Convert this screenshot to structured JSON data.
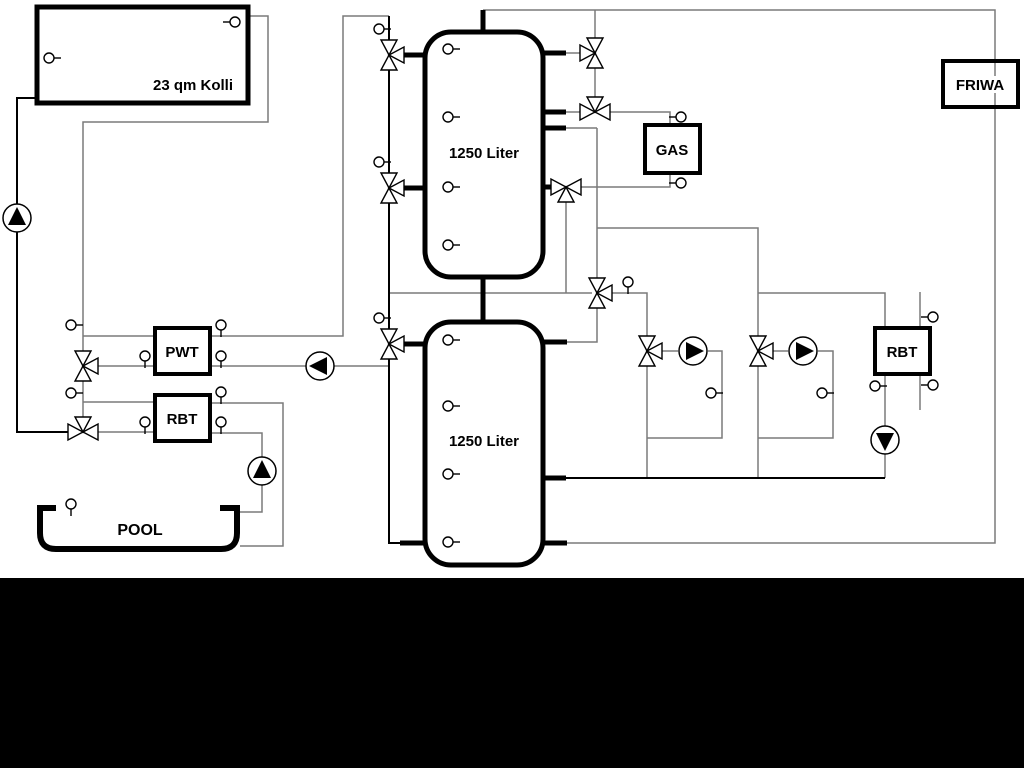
{
  "diagram_title": "hydraulic-heating-schematic",
  "labels": {
    "collector": "23 qm Kolli",
    "tank_top": "1250 Liter",
    "tank_bottom": "1250 Liter",
    "gas": "GAS",
    "friwa": "FRIWA",
    "pwt": "PWT",
    "rbt_left": "RBT",
    "rbt_right": "RBT",
    "pool": "POOL"
  },
  "colors": {
    "line_gray": "#7a7a7a",
    "line_black": "#000000",
    "background": "#ffffff",
    "bottom_band": "#000000",
    "component_fill": "#ffffff"
  },
  "components": {
    "sensors": [
      {
        "x": 49,
        "y": 58,
        "dir": "R",
        "name": "sensor-collector-left"
      },
      {
        "x": 235,
        "y": 22,
        "dir": "L",
        "name": "sensor-collector-top"
      },
      {
        "x": 379,
        "y": 29,
        "dir": "R",
        "name": "sensor-column-1"
      },
      {
        "x": 379,
        "y": 162,
        "dir": "R",
        "name": "sensor-column-2"
      },
      {
        "x": 379,
        "y": 318,
        "dir": "R",
        "name": "sensor-column-3"
      },
      {
        "x": 448,
        "y": 49,
        "dir": "R",
        "name": "sensor-tank1-1"
      },
      {
        "x": 448,
        "y": 117,
        "dir": "R",
        "name": "sensor-tank1-2"
      },
      {
        "x": 448,
        "y": 187,
        "dir": "R",
        "name": "sensor-tank1-3"
      },
      {
        "x": 448,
        "y": 245,
        "dir": "R",
        "name": "sensor-tank1-4"
      },
      {
        "x": 448,
        "y": 340,
        "dir": "R",
        "name": "sensor-tank2-1"
      },
      {
        "x": 448,
        "y": 406,
        "dir": "R",
        "name": "sensor-tank2-2"
      },
      {
        "x": 448,
        "y": 474,
        "dir": "R",
        "name": "sensor-tank2-3"
      },
      {
        "x": 448,
        "y": 542,
        "dir": "R",
        "name": "sensor-tank2-4"
      },
      {
        "x": 681,
        "y": 117,
        "dir": "L",
        "name": "sensor-gas-supply"
      },
      {
        "x": 681,
        "y": 183,
        "dir": "L",
        "name": "sensor-gas-return"
      },
      {
        "x": 628,
        "y": 282,
        "dir": "D",
        "name": "sensor-distribution"
      },
      {
        "x": 71,
        "y": 325,
        "dir": "R",
        "name": "sensor-pwt-line"
      },
      {
        "x": 145,
        "y": 356,
        "dir": "D",
        "name": "sensor-pwt-left"
      },
      {
        "x": 221,
        "y": 325,
        "dir": "D",
        "name": "sensor-pwt-right-top"
      },
      {
        "x": 221,
        "y": 356,
        "dir": "D",
        "name": "sensor-pwt-right-bottom"
      },
      {
        "x": 71,
        "y": 393,
        "dir": "R",
        "name": "sensor-rbt-line"
      },
      {
        "x": 145,
        "y": 422,
        "dir": "D",
        "name": "sensor-rbt-left"
      },
      {
        "x": 221,
        "y": 392,
        "dir": "D",
        "name": "sensor-rbt-right-top"
      },
      {
        "x": 221,
        "y": 422,
        "dir": "D",
        "name": "sensor-rbt-right-bottom"
      },
      {
        "x": 71,
        "y": 504,
        "dir": "D",
        "name": "sensor-pool"
      },
      {
        "x": 711,
        "y": 393,
        "dir": "R",
        "name": "sensor-circuit1"
      },
      {
        "x": 822,
        "y": 393,
        "dir": "R",
        "name": "sensor-circuit2"
      },
      {
        "x": 875,
        "y": 386,
        "dir": "R",
        "name": "sensor-rbt2-left"
      },
      {
        "x": 933,
        "y": 317,
        "dir": "L",
        "name": "sensor-rbt2-top"
      },
      {
        "x": 933,
        "y": 385,
        "dir": "L",
        "name": "sensor-rbt2-bottom"
      }
    ],
    "valves": [
      {
        "x": 595,
        "y": 53,
        "type": "vl",
        "name": "valve-tank1-top-right"
      },
      {
        "x": 595,
        "y": 112,
        "type": "ht",
        "name": "valve-gas-supply"
      },
      {
        "x": 566,
        "y": 187,
        "type": "hb",
        "name": "valve-gas-return"
      },
      {
        "x": 389,
        "y": 55,
        "type": "vr",
        "name": "valve-tank1-top-left"
      },
      {
        "x": 389,
        "y": 188,
        "type": "vr",
        "name": "valve-tank1-mid-left"
      },
      {
        "x": 389,
        "y": 344,
        "type": "vr",
        "name": "valve-tank2-top-left"
      },
      {
        "x": 597,
        "y": 293,
        "type": "vr",
        "name": "valve-distribution"
      },
      {
        "x": 647,
        "y": 351,
        "type": "vr",
        "name": "valve-circuit1"
      },
      {
        "x": 758,
        "y": 351,
        "type": "vr",
        "name": "valve-circuit2"
      },
      {
        "x": 83,
        "y": 366,
        "type": "vr",
        "name": "valve-pwt"
      },
      {
        "x": 83,
        "y": 432,
        "type": "ht",
        "name": "valve-pool"
      }
    ],
    "pumps": [
      {
        "x": 17,
        "y": 218,
        "dir": "up",
        "name": "pump-solar"
      },
      {
        "x": 320,
        "y": 366,
        "dir": "left",
        "name": "pump-tank-charge"
      },
      {
        "x": 262,
        "y": 471,
        "dir": "up",
        "name": "pump-pool"
      },
      {
        "x": 693,
        "y": 351,
        "dir": "right",
        "name": "pump-circuit1"
      },
      {
        "x": 803,
        "y": 351,
        "dir": "right",
        "name": "pump-circuit2"
      },
      {
        "x": 885,
        "y": 440,
        "dir": "down",
        "name": "pump-rbt2"
      }
    ]
  }
}
